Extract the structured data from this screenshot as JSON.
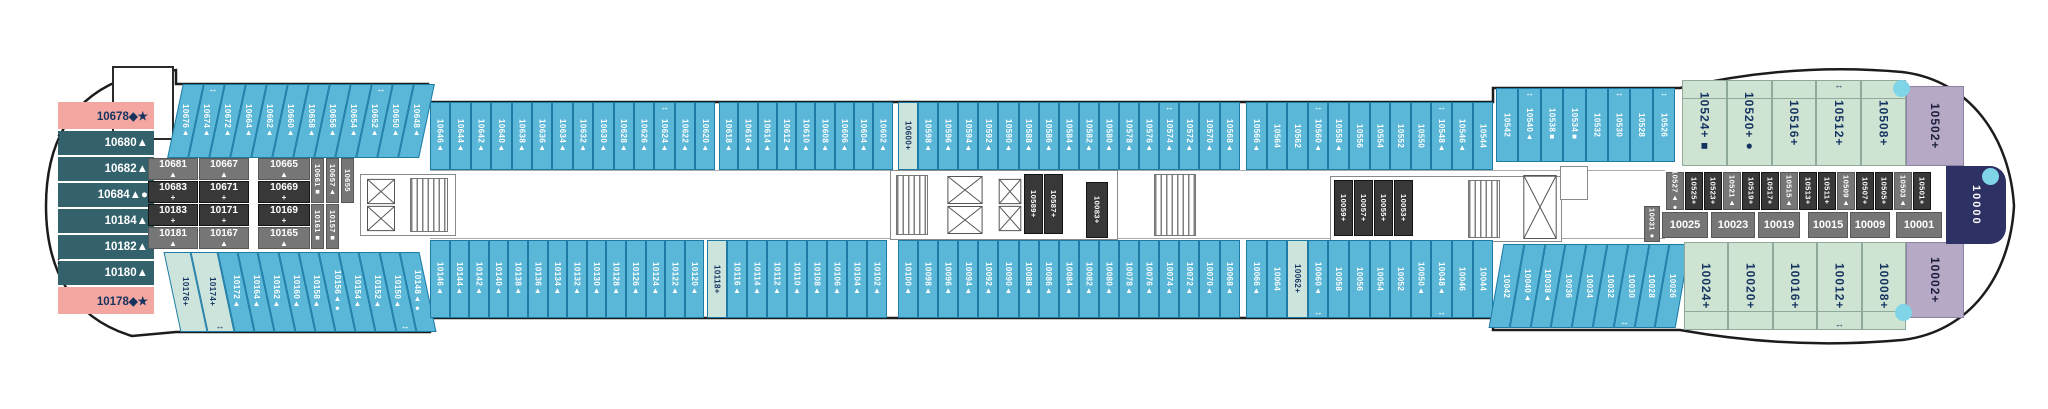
{
  "palette": {
    "balcony_blue": "#5ab7d8",
    "pale_special": "#cde4dd",
    "suite_green": "#cfe3d2",
    "suite_purple": "#b5a9c6",
    "aft_pink": "#f3a7a0",
    "aft_teal": "#33616c",
    "interior_dark": "#383838",
    "interior_gray": "#767676",
    "bow_navy": "#2e3163",
    "hull_line": "#1c1c1c",
    "dot_blue": "#7fd4e8"
  },
  "plan": {
    "stern_column": [
      {
        "n": "10678◆★",
        "t": "pink",
        "h": 27
      },
      {
        "n": "10680▲",
        "t": "teal",
        "h": 24
      },
      {
        "n": "10682▲",
        "t": "teal",
        "h": 24
      },
      {
        "n": "10684▲●",
        "t": "teal",
        "h": 24
      },
      {
        "n": "10184▲",
        "t": "teal",
        "h": 24
      },
      {
        "n": "10182▲",
        "t": "teal",
        "h": 24
      },
      {
        "n": "10180▲",
        "t": "teal",
        "h": 24
      },
      {
        "n": "10178◆★",
        "t": "pink",
        "h": 27
      }
    ],
    "top_segments": [
      {
        "x": 175,
        "y": 84,
        "h": 74,
        "cw": 21,
        "skew": -12,
        "edge": "top",
        "cabins": [
          {
            "n": "10676▲"
          },
          {
            "n": "10674▲",
            "a": 1
          },
          {
            "n": "10672▲"
          },
          {
            "n": "10664▲"
          },
          {
            "n": "10662▲"
          },
          {
            "n": "10660▲"
          },
          {
            "n": "10658▲"
          },
          {
            "n": "10656▲"
          },
          {
            "n": "10654▲"
          },
          {
            "n": "10652▲",
            "a": 1
          },
          {
            "n": "10650▲"
          },
          {
            "n": "10648▲"
          }
        ]
      },
      {
        "x": 430,
        "y": 102,
        "h": 68,
        "cw": 20.4,
        "edge": "top",
        "cabins": [
          {
            "n": "10646▲"
          },
          {
            "n": "10644▲"
          },
          {
            "n": "10642▲"
          },
          {
            "n": "10640▲"
          },
          {
            "n": "10638▲"
          },
          {
            "n": "10636▲"
          },
          {
            "n": "10634▲"
          },
          {
            "n": "10632▲"
          },
          {
            "n": "10630▲"
          },
          {
            "n": "10628▲"
          },
          {
            "n": "10626▲"
          },
          {
            "n": "10624▲",
            "a": 1
          },
          {
            "n": "10622▲"
          },
          {
            "n": "10620▲"
          }
        ]
      },
      {
        "x": 719,
        "y": 102,
        "h": 68,
        "cw": 19.3,
        "edge": "top",
        "cabins": [
          {
            "n": "10618▲"
          },
          {
            "n": "10616▲"
          },
          {
            "n": "10614▲"
          },
          {
            "n": "10612▲"
          },
          {
            "n": "10610▲"
          },
          {
            "n": "10608▲"
          },
          {
            "n": "10606▲"
          },
          {
            "n": "10604▲"
          },
          {
            "n": "10602▲"
          }
        ]
      },
      {
        "x": 898,
        "y": 102,
        "h": 68,
        "cw": 20.1,
        "edge": "top",
        "cabins": [
          {
            "n": "10600+",
            "t": "pale"
          },
          {
            "n": "10598▲"
          },
          {
            "n": "10596▲"
          },
          {
            "n": "10594▲"
          },
          {
            "n": "10592▲"
          },
          {
            "n": "10590▲"
          },
          {
            "n": "10588▲"
          },
          {
            "n": "10586▲"
          },
          {
            "n": "10584▲"
          },
          {
            "n": "10582▲"
          },
          {
            "n": "10580▲"
          },
          {
            "n": "10578▲"
          },
          {
            "n": "10576▲"
          },
          {
            "n": "10574▲",
            "a": 1
          },
          {
            "n": "10572▲"
          },
          {
            "n": "10570▲"
          },
          {
            "n": "10568▲"
          }
        ]
      },
      {
        "x": 1246,
        "y": 102,
        "h": 68,
        "cw": 20.6,
        "edge": "top",
        "cabins": [
          {
            "n": "10566▲"
          },
          {
            "n": "10564"
          },
          {
            "n": "10562"
          },
          {
            "n": "10560▲",
            "a": 1
          },
          {
            "n": "10558▲"
          },
          {
            "n": "10556"
          },
          {
            "n": "10554"
          },
          {
            "n": "10552"
          },
          {
            "n": "10550"
          },
          {
            "n": "10548▲",
            "a": 1
          },
          {
            "n": "10546▲"
          },
          {
            "n": "10544"
          }
        ]
      },
      {
        "x": 1496,
        "y": 88,
        "h": 74,
        "cw": 22.4,
        "edge": "top",
        "cabins": [
          {
            "n": "10542"
          },
          {
            "n": "10540▲",
            "a": 1
          },
          {
            "n": "10538■"
          },
          {
            "n": "10534■"
          },
          {
            "n": "10532"
          },
          {
            "n": "10530",
            "a": 1
          },
          {
            "n": "10528"
          },
          {
            "n": "10526",
            "a": 1
          }
        ]
      },
      {
        "x": 1682,
        "y": 80,
        "h": 86,
        "cw": 44.8,
        "edge": "top",
        "t": "green",
        "big": 1,
        "cabins": [
          {
            "n": "10524+■"
          },
          {
            "n": "10520+●"
          },
          {
            "n": "10516+"
          },
          {
            "n": "10512+",
            "a": 1
          },
          {
            "n": "10508+"
          }
        ]
      },
      {
        "x": 1906,
        "y": 86,
        "h": 80,
        "cw": 58,
        "edge": "top",
        "t": "purple",
        "big": 1,
        "cabins": [
          {
            "n": "10502+"
          }
        ]
      }
    ],
    "bottom_segments": [
      {
        "x": 172,
        "y": 252,
        "h": 80,
        "cw": 27,
        "skew": 12,
        "edge": "bottom",
        "t": "pale",
        "cabins": [
          {
            "n": "10176+"
          },
          {
            "n": "10174+",
            "a": 1
          }
        ]
      },
      {
        "x": 226,
        "y": 252,
        "h": 80,
        "cw": 20.2,
        "skew": 12,
        "edge": "bottom",
        "cabins": [
          {
            "n": "10172▲"
          },
          {
            "n": "10164▲"
          },
          {
            "n": "10162▲"
          },
          {
            "n": "10160▲"
          },
          {
            "n": "10158▲"
          },
          {
            "n": "10156▲●"
          },
          {
            "n": "10154▲"
          },
          {
            "n": "10152▲"
          },
          {
            "n": "10150▲",
            "a": 1
          },
          {
            "n": "10148▲●"
          }
        ]
      },
      {
        "x": 430,
        "y": 240,
        "h": 78,
        "cw": 19.6,
        "edge": "bottom",
        "cabins": [
          {
            "n": "10146▲"
          },
          {
            "n": "10144▲"
          },
          {
            "n": "10142▲"
          },
          {
            "n": "10140▲"
          },
          {
            "n": "10138▲"
          },
          {
            "n": "10136▲"
          },
          {
            "n": "10134▲"
          },
          {
            "n": "10132▲"
          },
          {
            "n": "10130▲"
          },
          {
            "n": "10128▲"
          },
          {
            "n": "10126▲"
          },
          {
            "n": "10124▲"
          },
          {
            "n": "10122▲"
          },
          {
            "n": "10120▲"
          }
        ]
      },
      {
        "x": 707,
        "y": 240,
        "h": 78,
        "cw": 20,
        "edge": "bottom",
        "cabins": [
          {
            "n": "10118+",
            "t": "pale"
          },
          {
            "n": "10116▲"
          },
          {
            "n": "10114▲"
          },
          {
            "n": "10112▲"
          },
          {
            "n": "10110▲"
          },
          {
            "n": "10108▲"
          },
          {
            "n": "10106▲"
          },
          {
            "n": "10104▲"
          },
          {
            "n": "10102▲"
          }
        ]
      },
      {
        "x": 898,
        "y": 240,
        "h": 78,
        "cw": 20.1,
        "edge": "bottom",
        "cabins": [
          {
            "n": "10100▲"
          },
          {
            "n": "10098▲"
          },
          {
            "n": "10096▲"
          },
          {
            "n": "10094▲"
          },
          {
            "n": "10092▲"
          },
          {
            "n": "10090▲"
          },
          {
            "n": "10088▲"
          },
          {
            "n": "10086▲"
          },
          {
            "n": "10084▲"
          },
          {
            "n": "10082▲"
          },
          {
            "n": "10080▲"
          },
          {
            "n": "10078▲"
          },
          {
            "n": "10076▲"
          },
          {
            "n": "10074▲"
          },
          {
            "n": "10072▲"
          },
          {
            "n": "10070▲"
          },
          {
            "n": "10068▲"
          }
        ]
      },
      {
        "x": 1246,
        "y": 240,
        "h": 78,
        "cw": 20.6,
        "edge": "bottom",
        "cabins": [
          {
            "n": "10066▲"
          },
          {
            "n": "10064"
          },
          {
            "n": "10062+",
            "t": "pale"
          },
          {
            "n": "10060▲",
            "a": 1
          },
          {
            "n": "10058"
          },
          {
            "n": "10056"
          },
          {
            "n": "10054"
          },
          {
            "n": "10052"
          },
          {
            "n": "10050▲"
          },
          {
            "n": "10048▲",
            "a": 1
          },
          {
            "n": "10046"
          },
          {
            "n": "10044"
          }
        ]
      },
      {
        "x": 1496,
        "y": 244,
        "h": 84,
        "cw": 20.8,
        "skew": -10,
        "edge": "bottom",
        "cabins": [
          {
            "n": "10042"
          },
          {
            "n": "10040▲"
          },
          {
            "n": "10038▲"
          },
          {
            "n": "10036"
          },
          {
            "n": "10034"
          },
          {
            "n": "10032"
          },
          {
            "n": "10030",
            "a": 1
          },
          {
            "n": "10028"
          },
          {
            "n": "10026"
          }
        ]
      },
      {
        "x": 1684,
        "y": 242,
        "h": 88,
        "cw": 44.4,
        "edge": "bottom",
        "t": "green",
        "big": 1,
        "cabins": [
          {
            "n": "10024+"
          },
          {
            "n": "10020+"
          },
          {
            "n": "10016+"
          },
          {
            "n": "10012+",
            "a": 1
          },
          {
            "n": "10008+"
          }
        ]
      },
      {
        "x": 1906,
        "y": 242,
        "h": 76,
        "cw": 58,
        "edge": "bottom",
        "t": "purple",
        "big": 1,
        "cabins": [
          {
            "n": "10002+"
          }
        ]
      }
    ],
    "aft_block": {
      "y": 158,
      "rh": 22,
      "gap": 1,
      "cols": [
        {
          "x": 148,
          "w": 50,
          "cells": [
            "10681▲",
            "10683+",
            "10183+",
            "10181▲"
          ]
        },
        {
          "x": 199,
          "w": 50,
          "cells": [
            "10667▲",
            "10671+",
            "10171+",
            "10167▲"
          ]
        },
        {
          "x": 258,
          "w": 52,
          "cells": [
            "10665▲",
            "10669+",
            "10169+",
            "10165▲"
          ]
        }
      ],
      "vtop": {
        "x": 311,
        "y": 158,
        "w": 13,
        "h": 45,
        "cabins": [
          "10661■",
          "10657▲",
          "10655"
        ]
      },
      "vbottom": {
        "x": 311,
        "y": 204,
        "w": 13,
        "h": 45,
        "cabins": [
          "10161■",
          "10157■"
        ]
      }
    },
    "interior": [
      {
        "k": "box",
        "x": 360,
        "y": 174,
        "w": 96,
        "h": 62
      },
      {
        "k": "box",
        "x": 890,
        "y": 170,
        "w": 228,
        "h": 70
      },
      {
        "k": "box",
        "x": 1330,
        "y": 176,
        "w": 232,
        "h": 66
      },
      {
        "k": "box",
        "x": 1560,
        "y": 166,
        "w": 28,
        "h": 34
      },
      {
        "k": "el2",
        "x": 366,
        "y": 178,
        "w": 30,
        "h": 54
      },
      {
        "k": "st",
        "x": 410,
        "y": 178,
        "w": 38,
        "h": 54
      },
      {
        "k": "st",
        "x": 896,
        "y": 175,
        "w": 32,
        "h": 60
      },
      {
        "k": "el2",
        "x": 946,
        "y": 175,
        "w": 38,
        "h": 60
      },
      {
        "k": "el2",
        "x": 998,
        "y": 178,
        "w": 24,
        "h": 54
      },
      {
        "k": "vc",
        "x": 1024,
        "y": 174,
        "w": 19,
        "h": 60,
        "n": "10589+"
      },
      {
        "k": "vc",
        "x": 1044,
        "y": 174,
        "w": 19,
        "h": 60,
        "n": "10587+"
      },
      {
        "k": "vc",
        "x": 1086,
        "y": 182,
        "w": 22,
        "h": 56,
        "n": "10083+"
      },
      {
        "k": "st",
        "x": 1154,
        "y": 174,
        "w": 42,
        "h": 62
      },
      {
        "k": "vc",
        "x": 1334,
        "y": 180,
        "w": 19,
        "h": 56,
        "n": "10059+"
      },
      {
        "k": "vc",
        "x": 1354,
        "y": 180,
        "w": 19,
        "h": 56,
        "n": "10057+"
      },
      {
        "k": "vc",
        "x": 1374,
        "y": 180,
        "w": 19,
        "h": 56,
        "n": "10055+"
      },
      {
        "k": "vc",
        "x": 1394,
        "y": 180,
        "w": 19,
        "h": 56,
        "n": "10053+"
      },
      {
        "k": "st",
        "x": 1468,
        "y": 180,
        "w": 32,
        "h": 58
      },
      {
        "k": "el1",
        "x": 1522,
        "y": 172,
        "w": 36,
        "h": 70
      }
    ],
    "right_top_row": {
      "x": 1666,
      "y": 172,
      "cw": 19,
      "h": 38,
      "cabins": [
        "10527▲●",
        "10525+",
        "10523+",
        "10521▲",
        "10519+",
        "10517+",
        "10515▲",
        "10513+",
        "10511+",
        "10509▲",
        "10507+",
        "10505+",
        "10503▲",
        "10501+"
      ]
    },
    "right_bottom_row": {
      "vcab": {
        "n": "10031●",
        "x": 1644,
        "y": 206,
        "w": 16,
        "h": 36
      },
      "y": 212,
      "h": 26,
      "cells": [
        {
          "n": "10025",
          "x": 1662,
          "w": 46
        },
        {
          "n": "10023",
          "x": 1711,
          "w": 44
        },
        {
          "n": "10019",
          "x": 1758,
          "w": 42
        },
        {
          "n": "10015",
          "x": 1808,
          "w": 40
        },
        {
          "n": "10009",
          "x": 1850,
          "w": 40
        },
        {
          "n": "10001",
          "x": 1896,
          "w": 46
        }
      ]
    },
    "bow_cabin": {
      "n": "10000",
      "x": 1946,
      "y": 166,
      "w": 60,
      "h": 78
    },
    "dots": [
      {
        "x": 1893,
        "y": 80
      },
      {
        "x": 1895,
        "y": 304
      },
      {
        "x": 1982,
        "y": 168
      }
    ],
    "hull_arrows": [
      {
        "n": "↕",
        "x": 56,
        "y": 132
      },
      {
        "n": "↕",
        "x": 56,
        "y": 256
      }
    ],
    "notch_box": {
      "x": 112,
      "y": 66,
      "w": 62,
      "h": 74
    },
    "corridor_lines": [
      {
        "x": 430,
        "y": 170,
        "w": 1235
      },
      {
        "x": 430,
        "y": 238,
        "w": 1235
      }
    ]
  }
}
